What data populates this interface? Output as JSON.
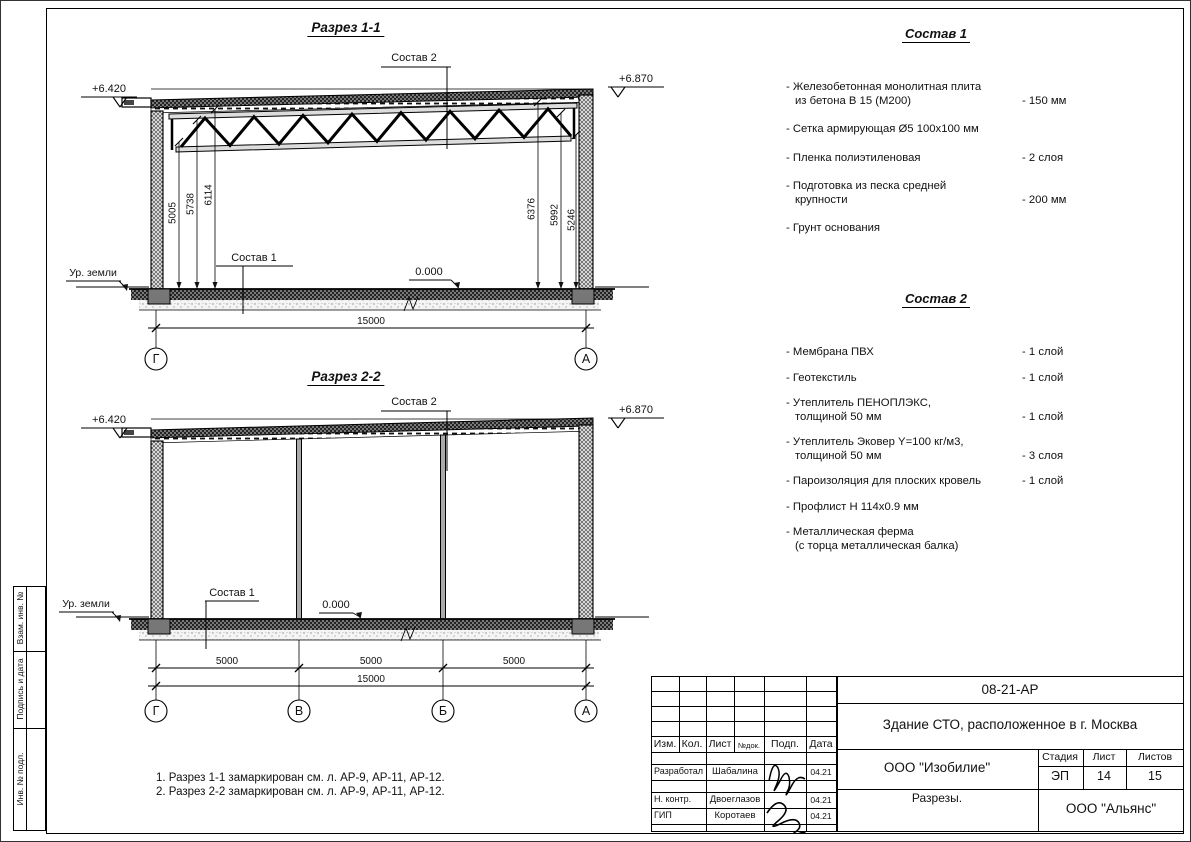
{
  "side_strip": {
    "labels": [
      "Взам. инв. №",
      "Подпись и дата",
      "Инв. № подл."
    ]
  },
  "sections": {
    "s1": {
      "title": "Разрез 1-1",
      "elev_left": "+6.420",
      "elev_right": "+6.870",
      "sostav2_label": "Состав 2",
      "sostav1_label": "Состав 1",
      "zero_level": "0.000",
      "ground": "Ур. земли",
      "dims_left": [
        "5005",
        "5738",
        "6114"
      ],
      "dims_right": [
        "6376",
        "5992",
        "5246"
      ],
      "total": "15000",
      "axes": [
        "Г",
        "А"
      ]
    },
    "s2": {
      "title": "Разрез 2-2",
      "elev_left": "+6.420",
      "elev_right": "+6.870",
      "sostav2_label": "Состав 2",
      "sostav1_label": "Состав 1",
      "zero_level": "0.000",
      "ground": "Ур. земли",
      "spans": [
        "5000",
        "5000",
        "5000"
      ],
      "total": "15000",
      "axes": [
        "Г",
        "В",
        "Б",
        "А"
      ]
    }
  },
  "sostav1": {
    "title": "Состав 1",
    "items": [
      {
        "l1": "- Железобетонная  монолитная плита",
        "l2": "из бетона В 15 (М200)",
        "value": "- 150 мм"
      },
      {
        "l1": "- Сетка армирующая Ø5 100х100 мм",
        "value": ""
      },
      {
        "l1": "- Пленка полиэтиленовая",
        "value": "-  2 слоя"
      },
      {
        "l1": "- Подготовка из песка средней",
        "l2": "крупности",
        "value": "- 200 мм"
      },
      {
        "l1": "- Грунт основания",
        "value": ""
      }
    ]
  },
  "sostav2": {
    "title": "Состав 2",
    "items": [
      {
        "l1": "- Мембрана ПВХ",
        "value": "- 1 слой"
      },
      {
        "l1": "- Геотекстиль",
        "value": "- 1 слой"
      },
      {
        "l1": "- Утеплитель ПЕНОПЛЭКС,",
        "l2": "толщиной 50 мм",
        "value": "- 1 слой"
      },
      {
        "l1": "- Утеплитель Эковер Y=100 кг/м3,",
        "l2": "толщиной 50 мм",
        "value": "- 3 слоя"
      },
      {
        "l1": "- Пароизоляция для плоских кровель",
        "value": "- 1 слой"
      },
      {
        "l1": "- Профлист Н 114х0.9 мм",
        "value": ""
      },
      {
        "l1": "- Металлическая ферма",
        "l2": "(с торца металлическая балка)",
        "value": ""
      }
    ]
  },
  "notes": [
    "1. Разрез 1-1 замаркирован см. л. АР-9, АР-11, АР-12.",
    "2. Разрез 2-2 замаркирован см. л. АР-9, АР-11, АР-12."
  ],
  "stamp": {
    "doc_number": "08-21-АР",
    "project_title": "Здание СТО, расположенное в г. Москва",
    "company": "ООО \"Изобилие\"",
    "drawing_title": "Разрезы.",
    "contractor": "ООО \"Альянс\"",
    "stage_label": "Стадия",
    "stage_value": "ЭП",
    "sheet_label": "Лист",
    "sheet_value": "14",
    "sheets_label": "Листов",
    "sheets_value": "15",
    "columns": [
      "Изм.",
      "Кол.",
      "Лист",
      "№док.",
      "Подп.",
      "Дата"
    ],
    "rows": [
      {
        "role": "Разработал",
        "name": "Шабалина",
        "date": "04.21"
      },
      {
        "role": "Н. контр.",
        "name": "Двоеглазов",
        "date": "04.21"
      },
      {
        "role": "ГИП",
        "name": "Коротаев",
        "date": "04.21"
      }
    ]
  }
}
